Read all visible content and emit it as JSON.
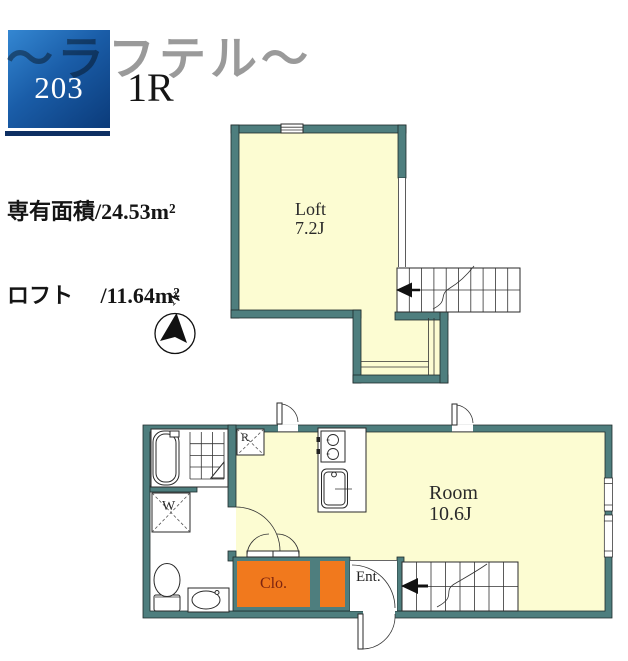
{
  "header": {
    "title": "〜ラフテル〜",
    "room_number": "203",
    "room_type": "1R",
    "area_line1": "専有面積/24.53m²",
    "area_line2": "ロフト　 /11.64m²"
  },
  "compass": {
    "north": "N"
  },
  "loft": {
    "name": "Loft",
    "size": "7.2J"
  },
  "room": {
    "name": "Room",
    "size": "10.6J"
  },
  "fixtures": {
    "refrigerator": "R",
    "washer": "W",
    "closet": "Clo.",
    "entrance": "Ent."
  },
  "colors": {
    "wall": "#4e7e7e",
    "floor": "#fcfcd2",
    "closet": "#f1791d",
    "brand-blue-light": "#3487d2",
    "brand-blue-dark": "#0b3b7a",
    "title-gray": "#9a9a9a",
    "navy-bar": "#0e2f63",
    "closet-text": "#7c2410"
  }
}
